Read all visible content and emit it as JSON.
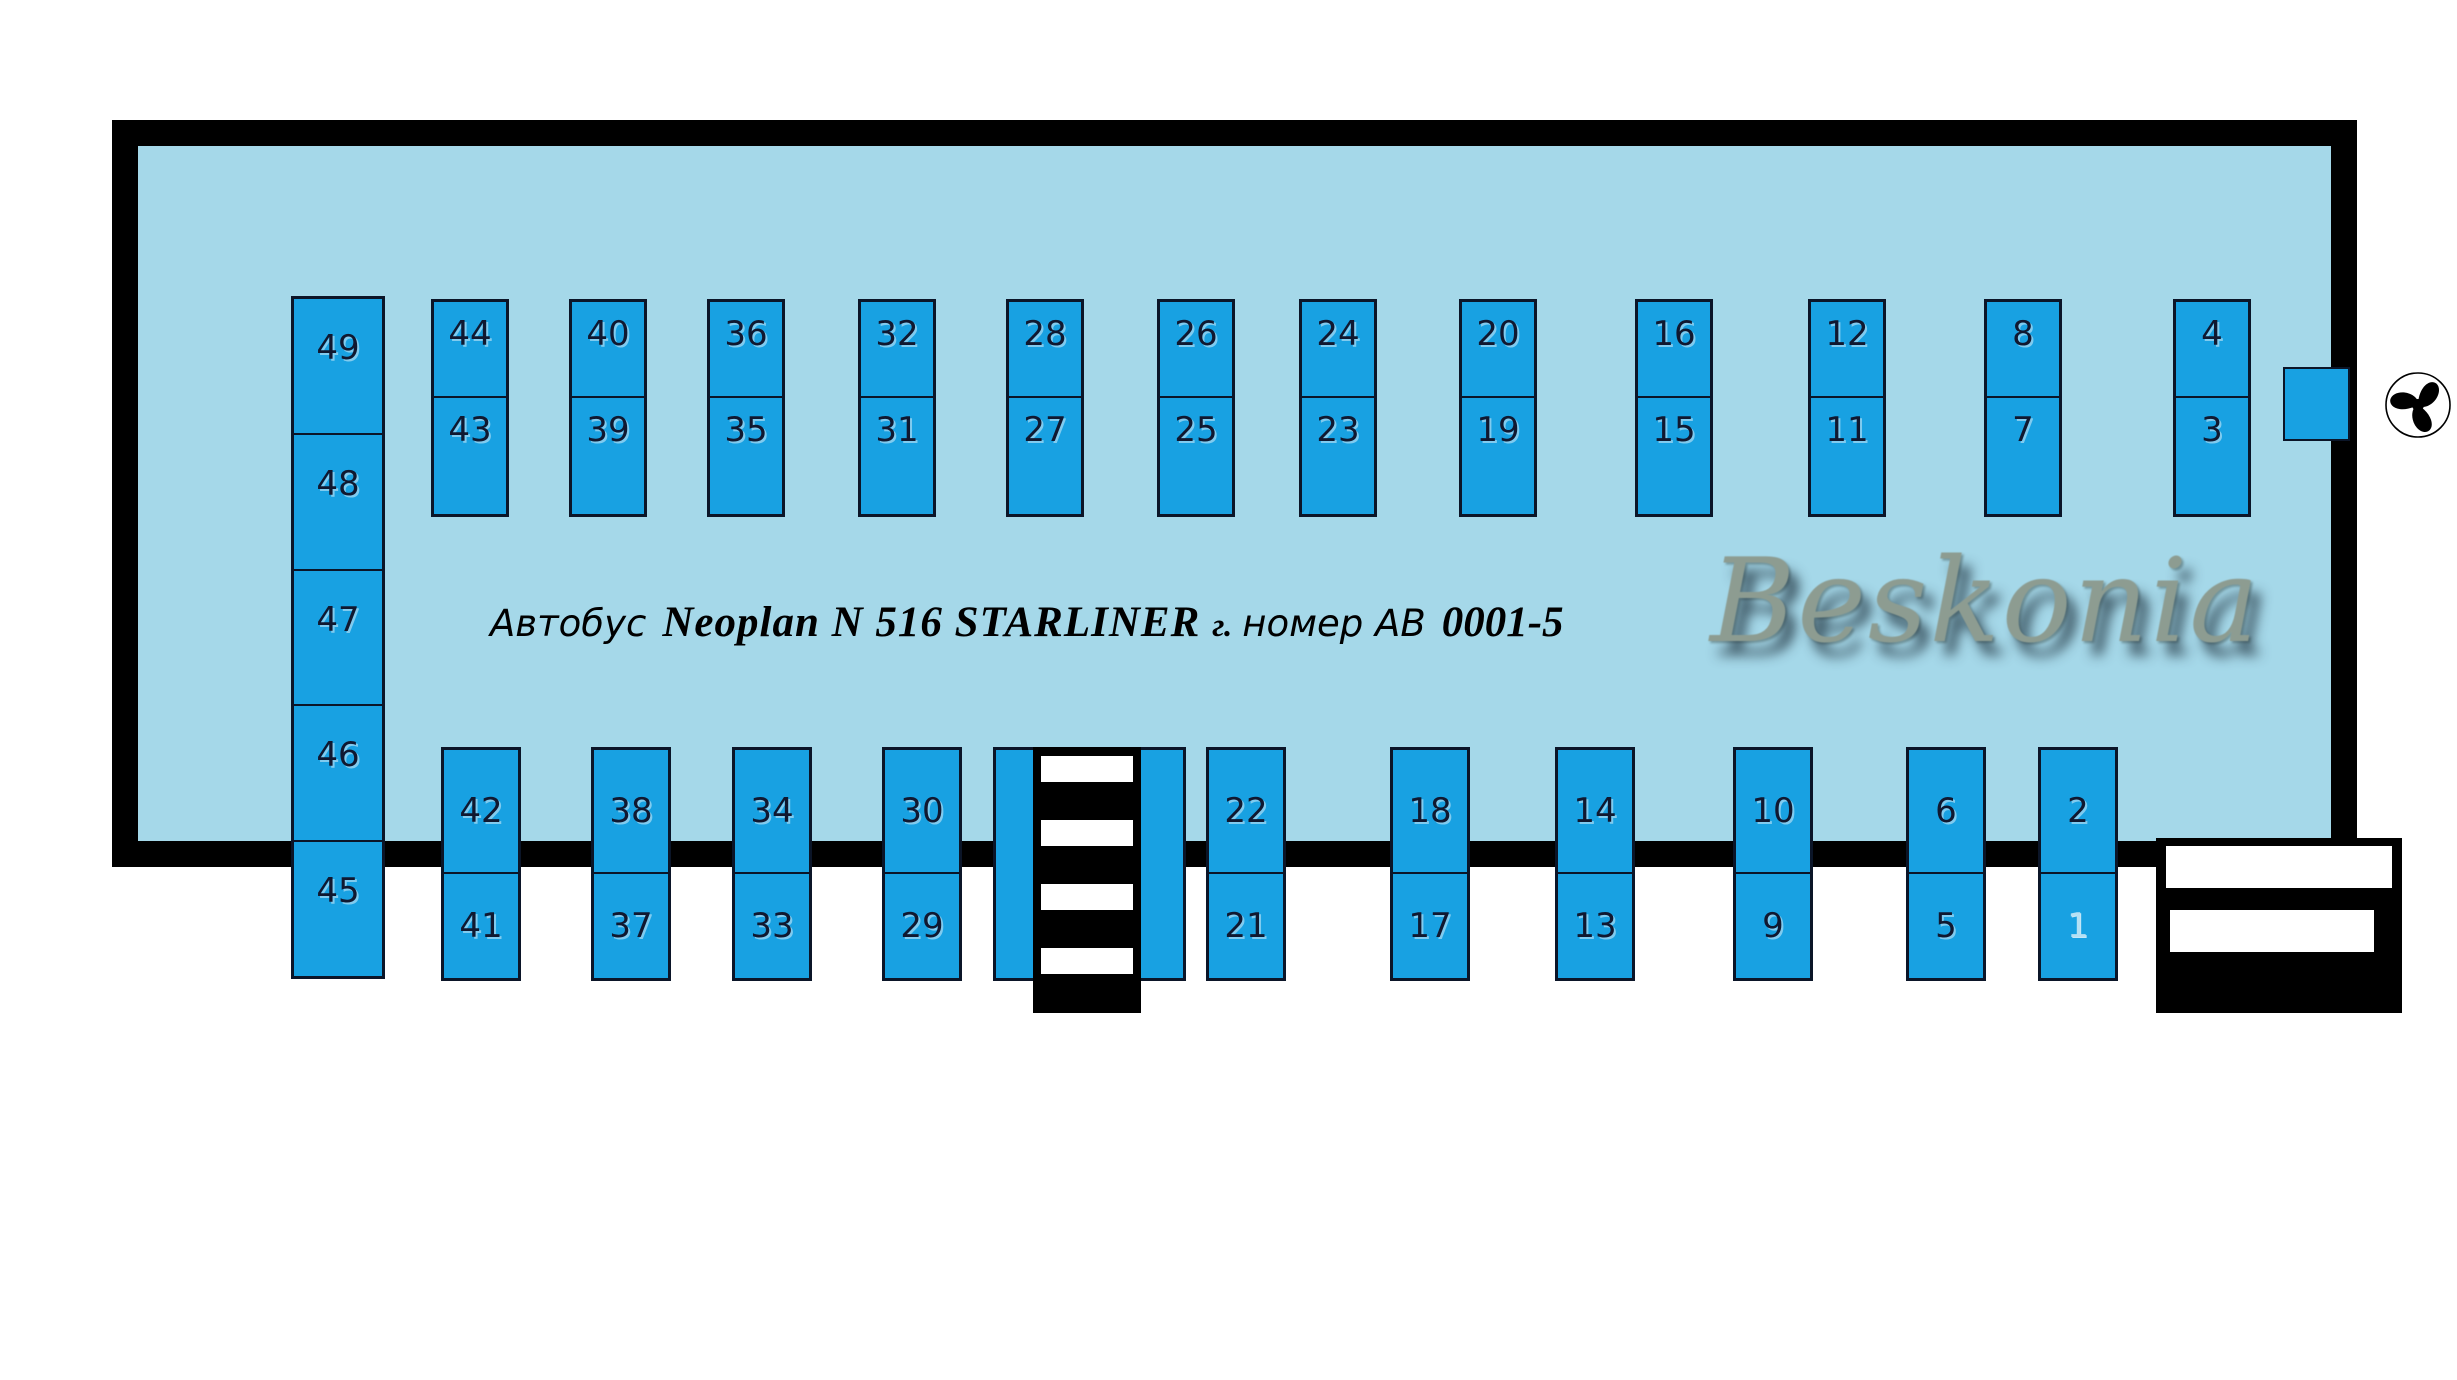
{
  "title": {
    "prefix": "Автобус",
    "model": "Neoplan N 516 STARLINER",
    "city_abbr": "г.",
    "number_label": "номер АВ",
    "plate": "0001-5"
  },
  "watermark": "Beskonia",
  "colors": {
    "bus_background": "#a5d8e9",
    "seat_fill": "#18a1e2",
    "seat_border": "#0b1528",
    "bus_outline": "#000000",
    "watermark_color": "#8d9c91"
  },
  "seats": {
    "back_row_column": [
      "49",
      "48",
      "47",
      "46",
      "45"
    ],
    "upper_row_pairs": [
      [
        "44",
        "43"
      ],
      [
        "40",
        "39"
      ],
      [
        "36",
        "35"
      ],
      [
        "32",
        "31"
      ],
      [
        "28",
        "27"
      ],
      [
        "26",
        "25"
      ],
      [
        "24",
        "23"
      ],
      [
        "20",
        "19"
      ],
      [
        "16",
        "15"
      ],
      [
        "12",
        "11"
      ],
      [
        "8",
        "7"
      ],
      [
        "4",
        "3"
      ]
    ],
    "lower_row_pairs": [
      [
        "42",
        "41"
      ],
      [
        "38",
        "37"
      ],
      [
        "34",
        "33"
      ],
      [
        "30",
        "29"
      ],
      [
        "22",
        "21"
      ],
      [
        "18",
        "17"
      ],
      [
        "14",
        "13"
      ],
      [
        "10",
        "9"
      ],
      [
        "6",
        "5"
      ],
      [
        "2",
        "1"
      ]
    ],
    "faded_seats": [
      "1"
    ]
  },
  "icons": {
    "steering_wheel": "steering-wheel-icon",
    "middle_door_stairs": "stairs-icon",
    "front_door_steps": "steps-icon"
  }
}
